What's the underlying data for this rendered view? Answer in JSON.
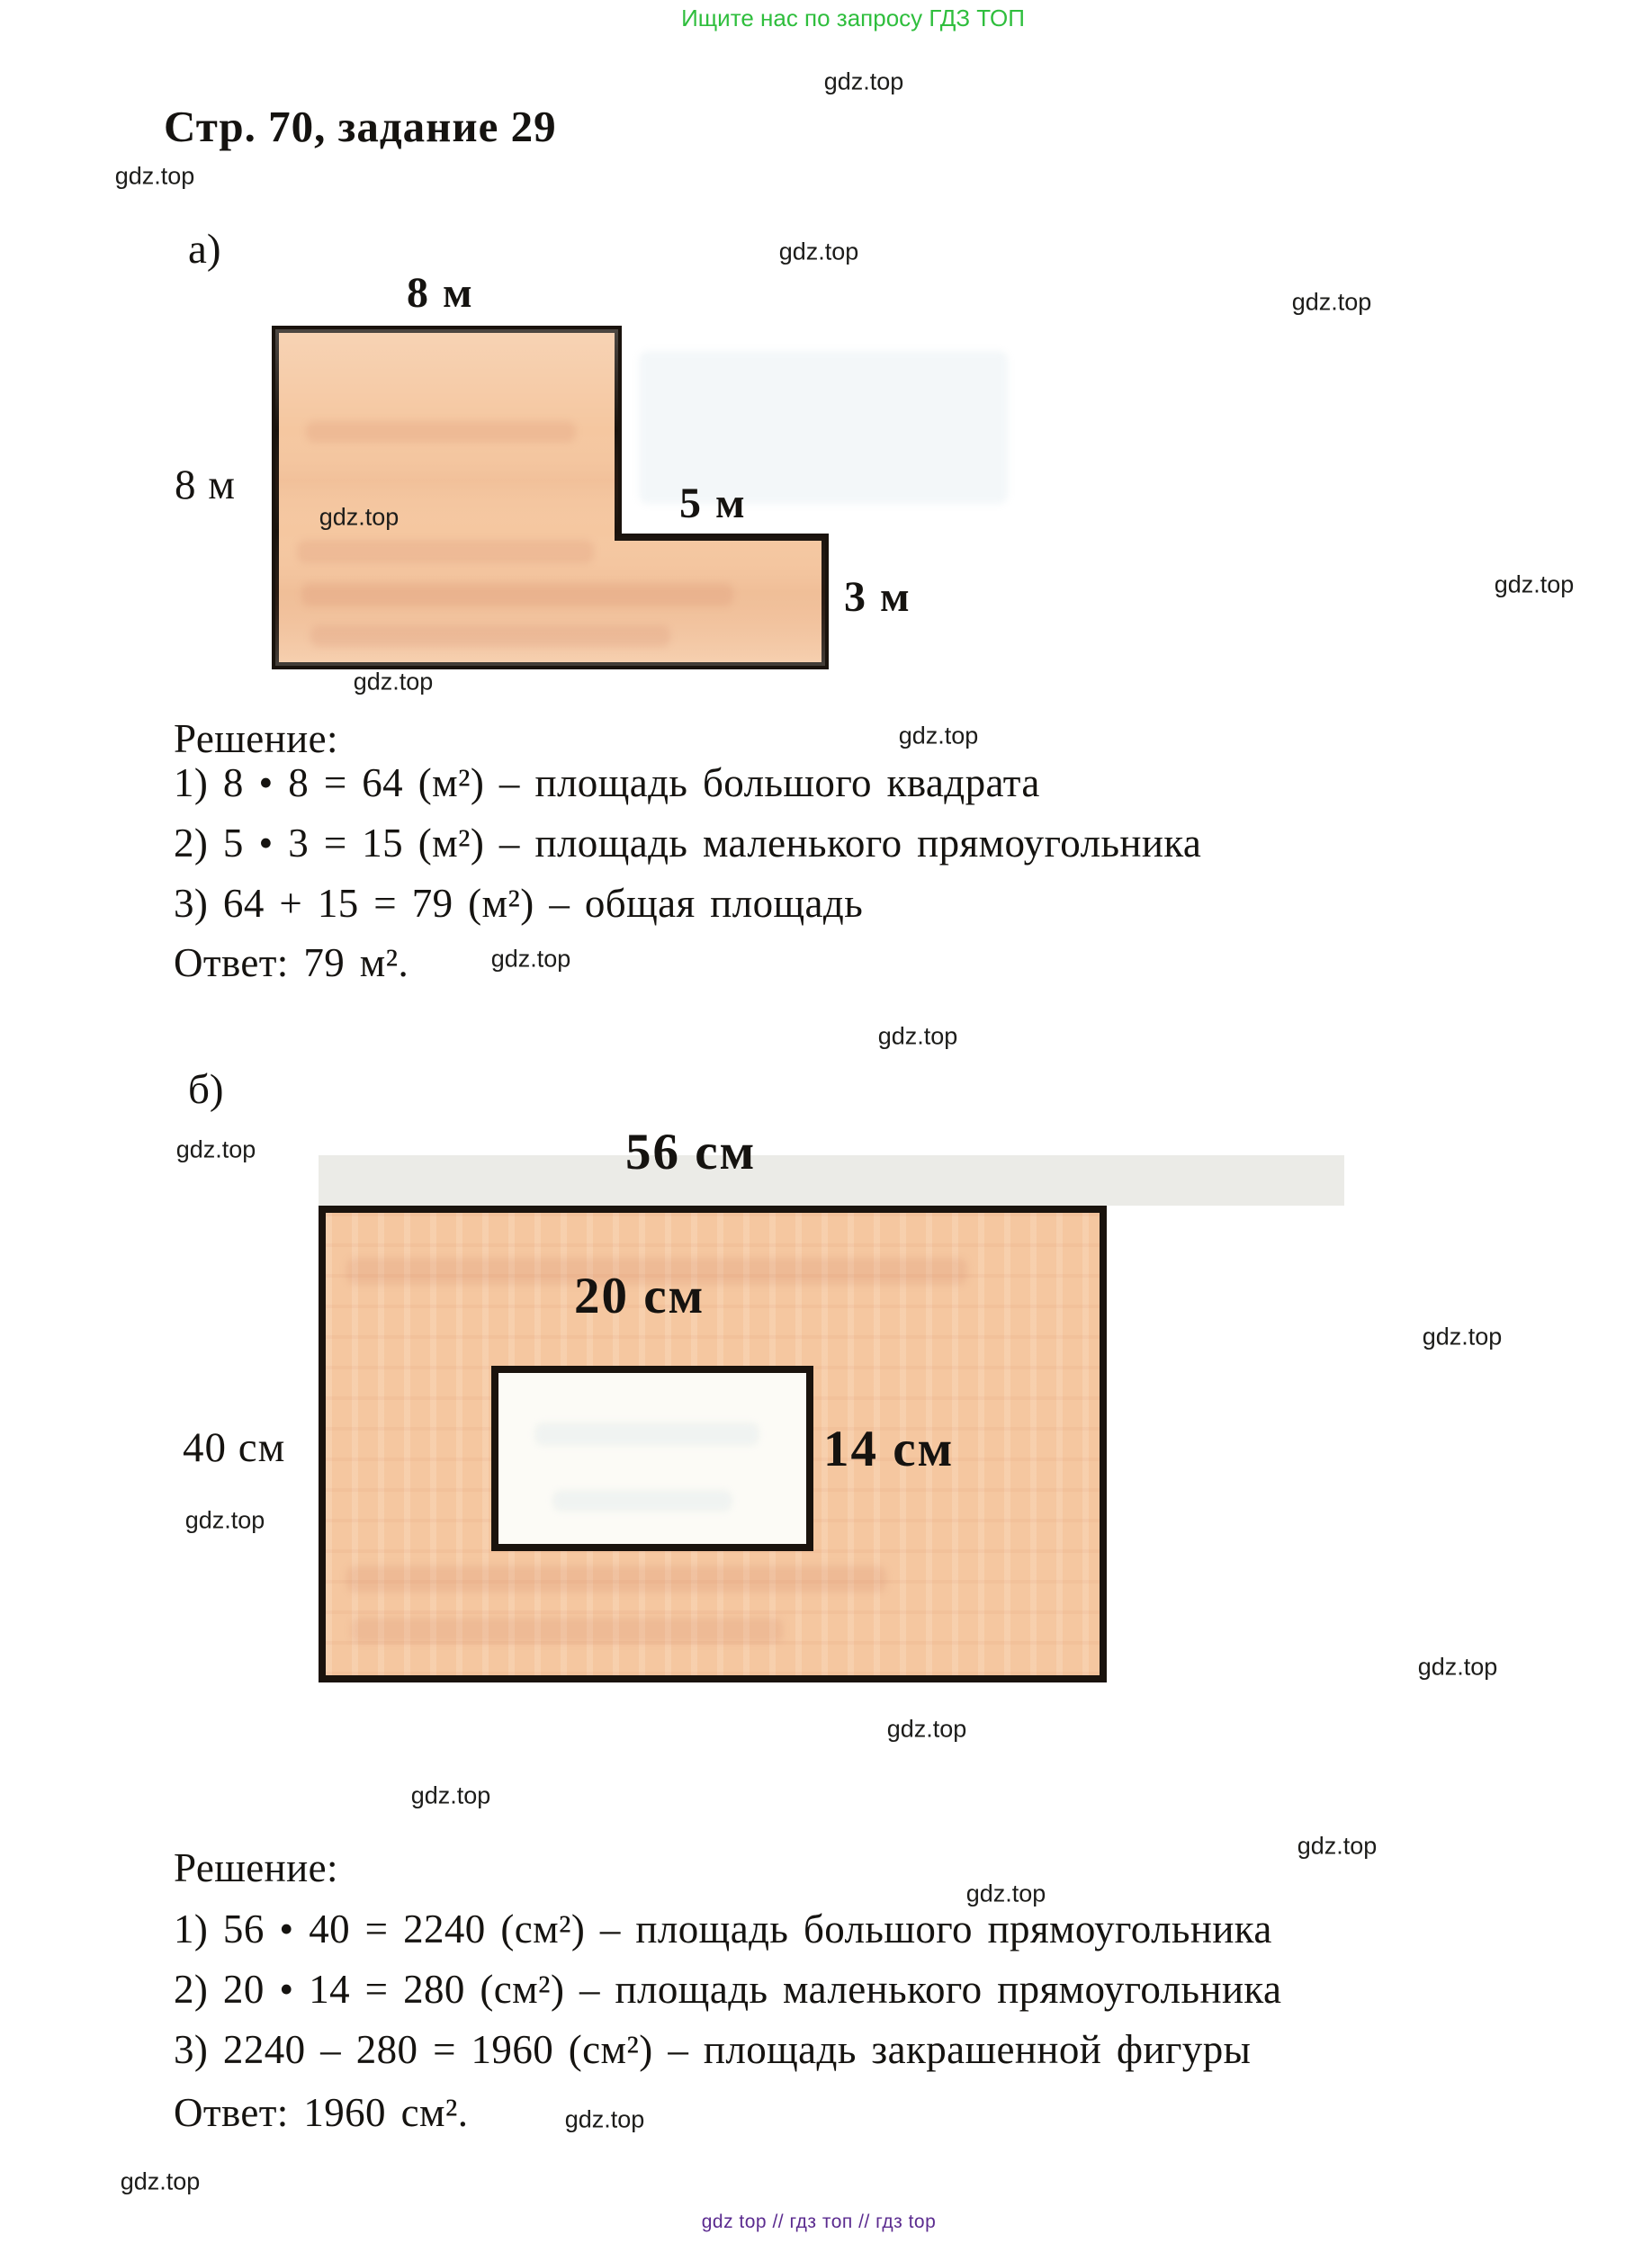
{
  "page": {
    "promo_top": "Ищите нас по запросу ГДЗ ТОП",
    "title": "Стр. 70, задание 29",
    "watermark": "gdz.top",
    "footer": "gdz top  //  гдз топ  //  гдз top"
  },
  "colors": {
    "promo_green": "#2fbe3d",
    "footer_purple": "#5b2b8f",
    "shape_fill": "#f5c7a0",
    "shape_border": "#1a130d"
  },
  "section_a": {
    "label": "а)",
    "figure": {
      "top_label": "8 м",
      "left_label": "8 м",
      "step_label": "5 м",
      "right_label": "3 м"
    },
    "solution": {
      "heading": "Решение:",
      "steps": [
        "1) 8 • 8 = 64 (м²) – площадь большого квадрата",
        "2) 5 • 3 = 15 (м²) – площадь маленького прямоугольника",
        "3) 64 + 15 = 79 (м²) – общая площадь"
      ],
      "answer": "Ответ: 79 м²."
    }
  },
  "section_b": {
    "label": "б)",
    "figure": {
      "width_label": "56 см",
      "height_label": "40 см",
      "inner_width_label": "20 см",
      "inner_height_label": "14 см"
    },
    "solution": {
      "heading": "Решение:",
      "steps": [
        "1) 56 • 40 = 2240 (см²) – площадь большого прямоугольника",
        "2) 20 • 14 = 280 (см²) – площадь маленького прямоугольника",
        "3) 2240 – 280 = 1960 (см²) – площадь закрашенной фигуры"
      ],
      "answer": "Ответ: 1960 см²."
    }
  }
}
